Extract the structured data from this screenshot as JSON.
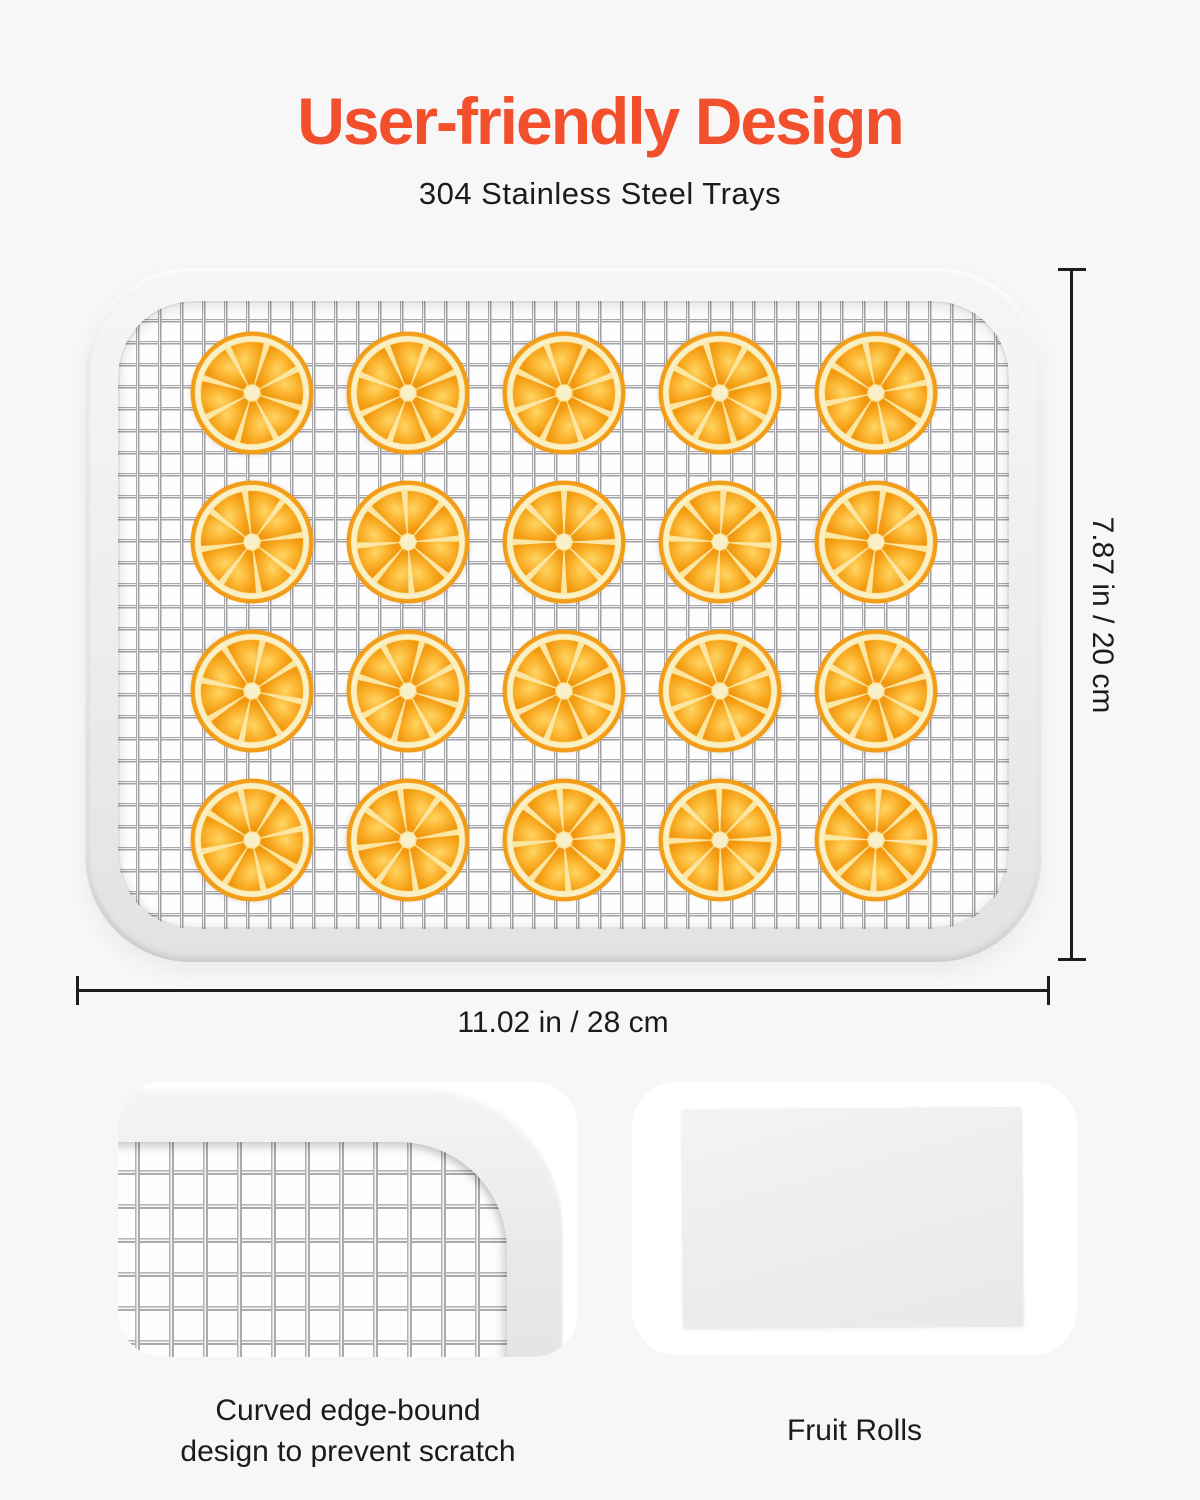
{
  "header": {
    "title": "User-friendly Design",
    "subtitle": "304 Stainless Steel Trays"
  },
  "tray": {
    "rows": 4,
    "cols": 5,
    "item": "orange-slice",
    "slice_count": 20
  },
  "dimensions": {
    "height": "7.87 in / 20 cm",
    "width": "11.02 in / 28 cm"
  },
  "features": [
    {
      "caption": "Curved edge-bound design to prevent scratch"
    },
    {
      "caption": "Fruit Rolls"
    }
  ],
  "colors": {
    "accent": "#F2502C",
    "text": "#1B1B1B",
    "background": "#F7F7F8",
    "orange_flesh": "#F9A91F",
    "orange_pith": "#FAF0C6",
    "mesh_wire": "#A9A9AD"
  }
}
